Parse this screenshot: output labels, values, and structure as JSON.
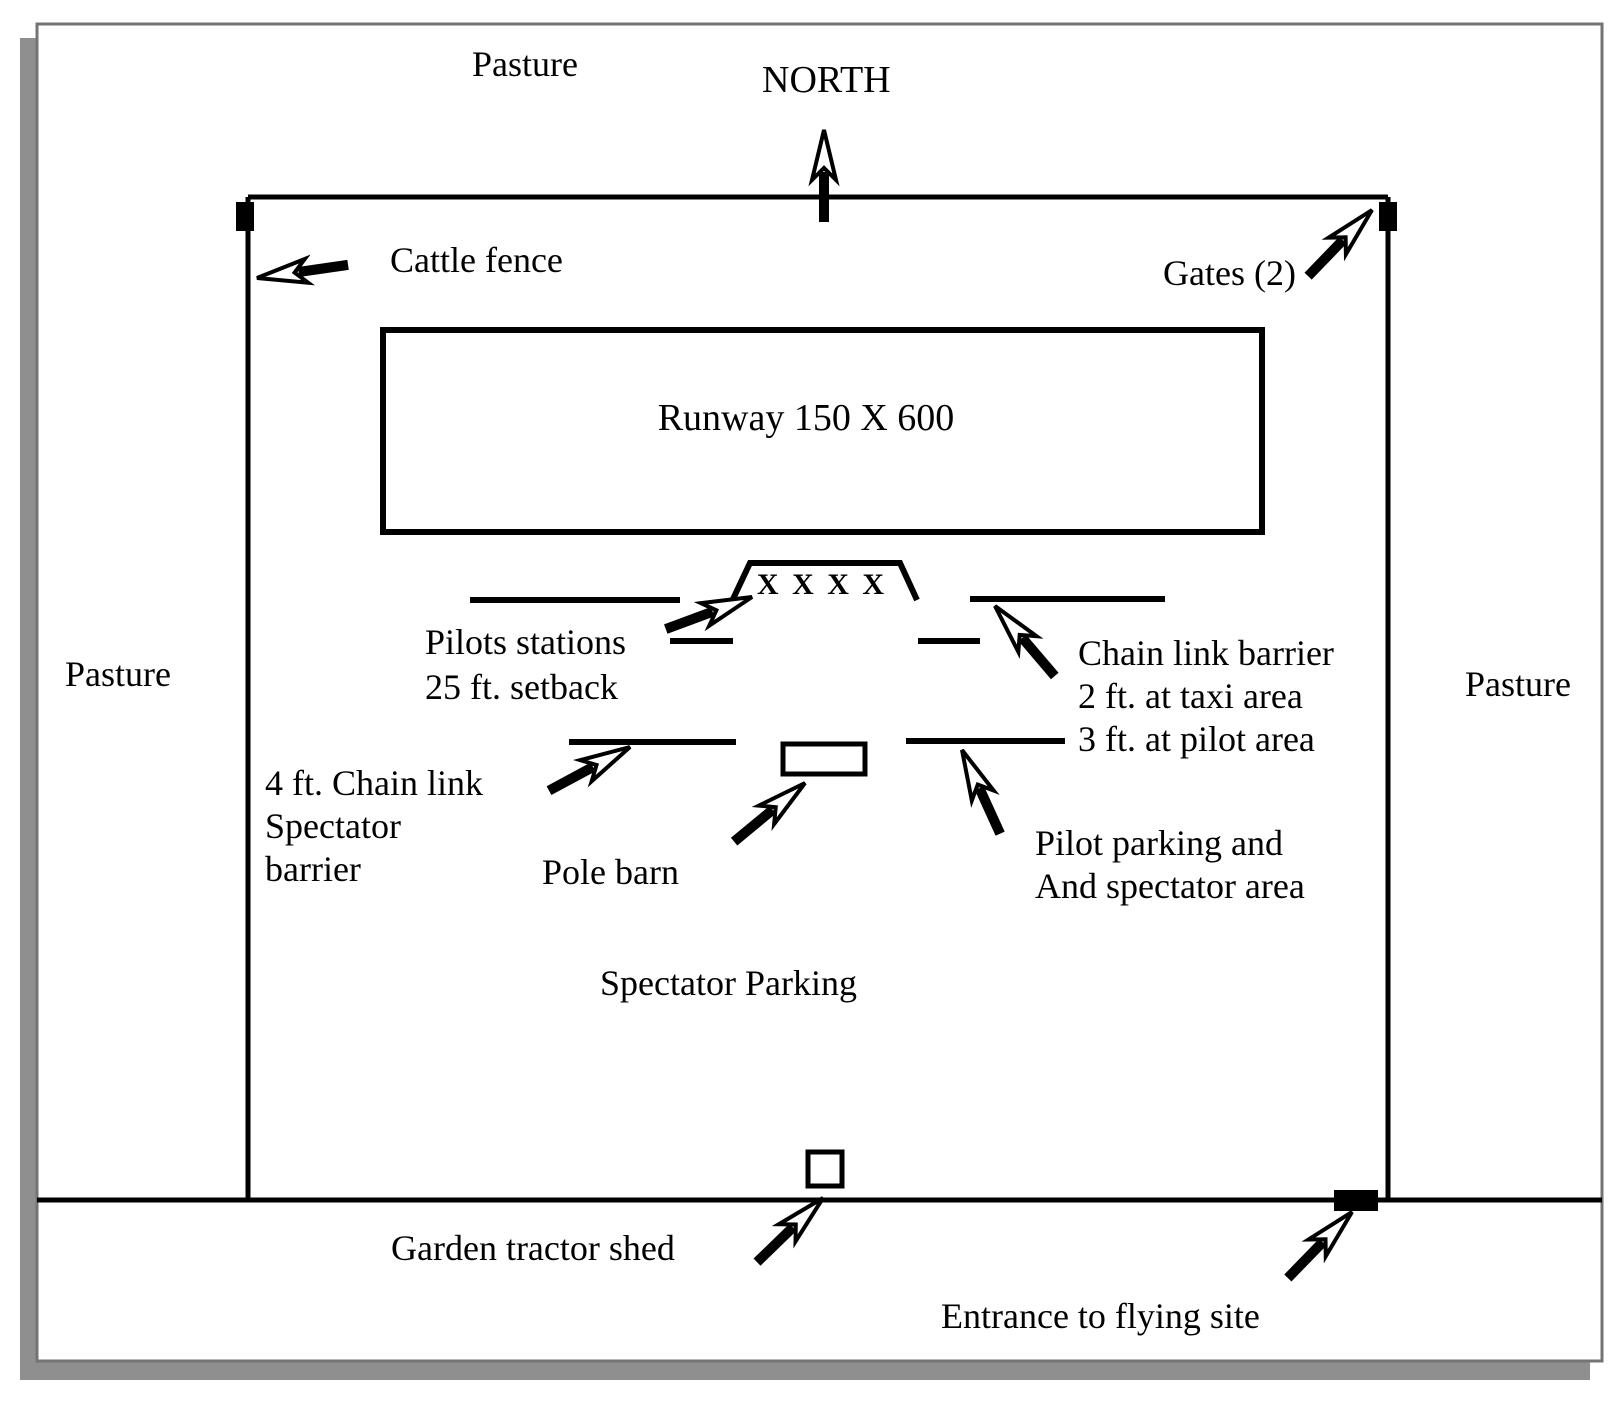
{
  "colors": {
    "ink": "#000000",
    "page_border": "#747474",
    "shadow": "#8f8f8f",
    "background": "#ffffff"
  },
  "labels": {
    "pasture_top": "Pasture",
    "pasture_left": "Pasture",
    "pasture_right": "Pasture",
    "north": "NORTH",
    "cattle_fence": "Cattle fence",
    "gates": "Gates (2)",
    "runway": "Runway 150 X 600",
    "pilot_stations": [
      "Pilots stations",
      "25 ft. setback"
    ],
    "pilot_station_marks": "X X X X",
    "chain_link_barrier": [
      "Chain link barrier",
      "2 ft. at taxi area",
      "3 ft. at pilot area"
    ],
    "spectator_barrier": [
      "4 ft. Chain link",
      "Spectator",
      "barrier"
    ],
    "pole_barn": "Pole barn",
    "pilot_parking": [
      "Pilot parking and",
      "And spectator area"
    ],
    "spectator_parking": "Spectator Parking",
    "garden_tractor_shed": "Garden tractor shed",
    "entrance": "Entrance to flying site"
  }
}
